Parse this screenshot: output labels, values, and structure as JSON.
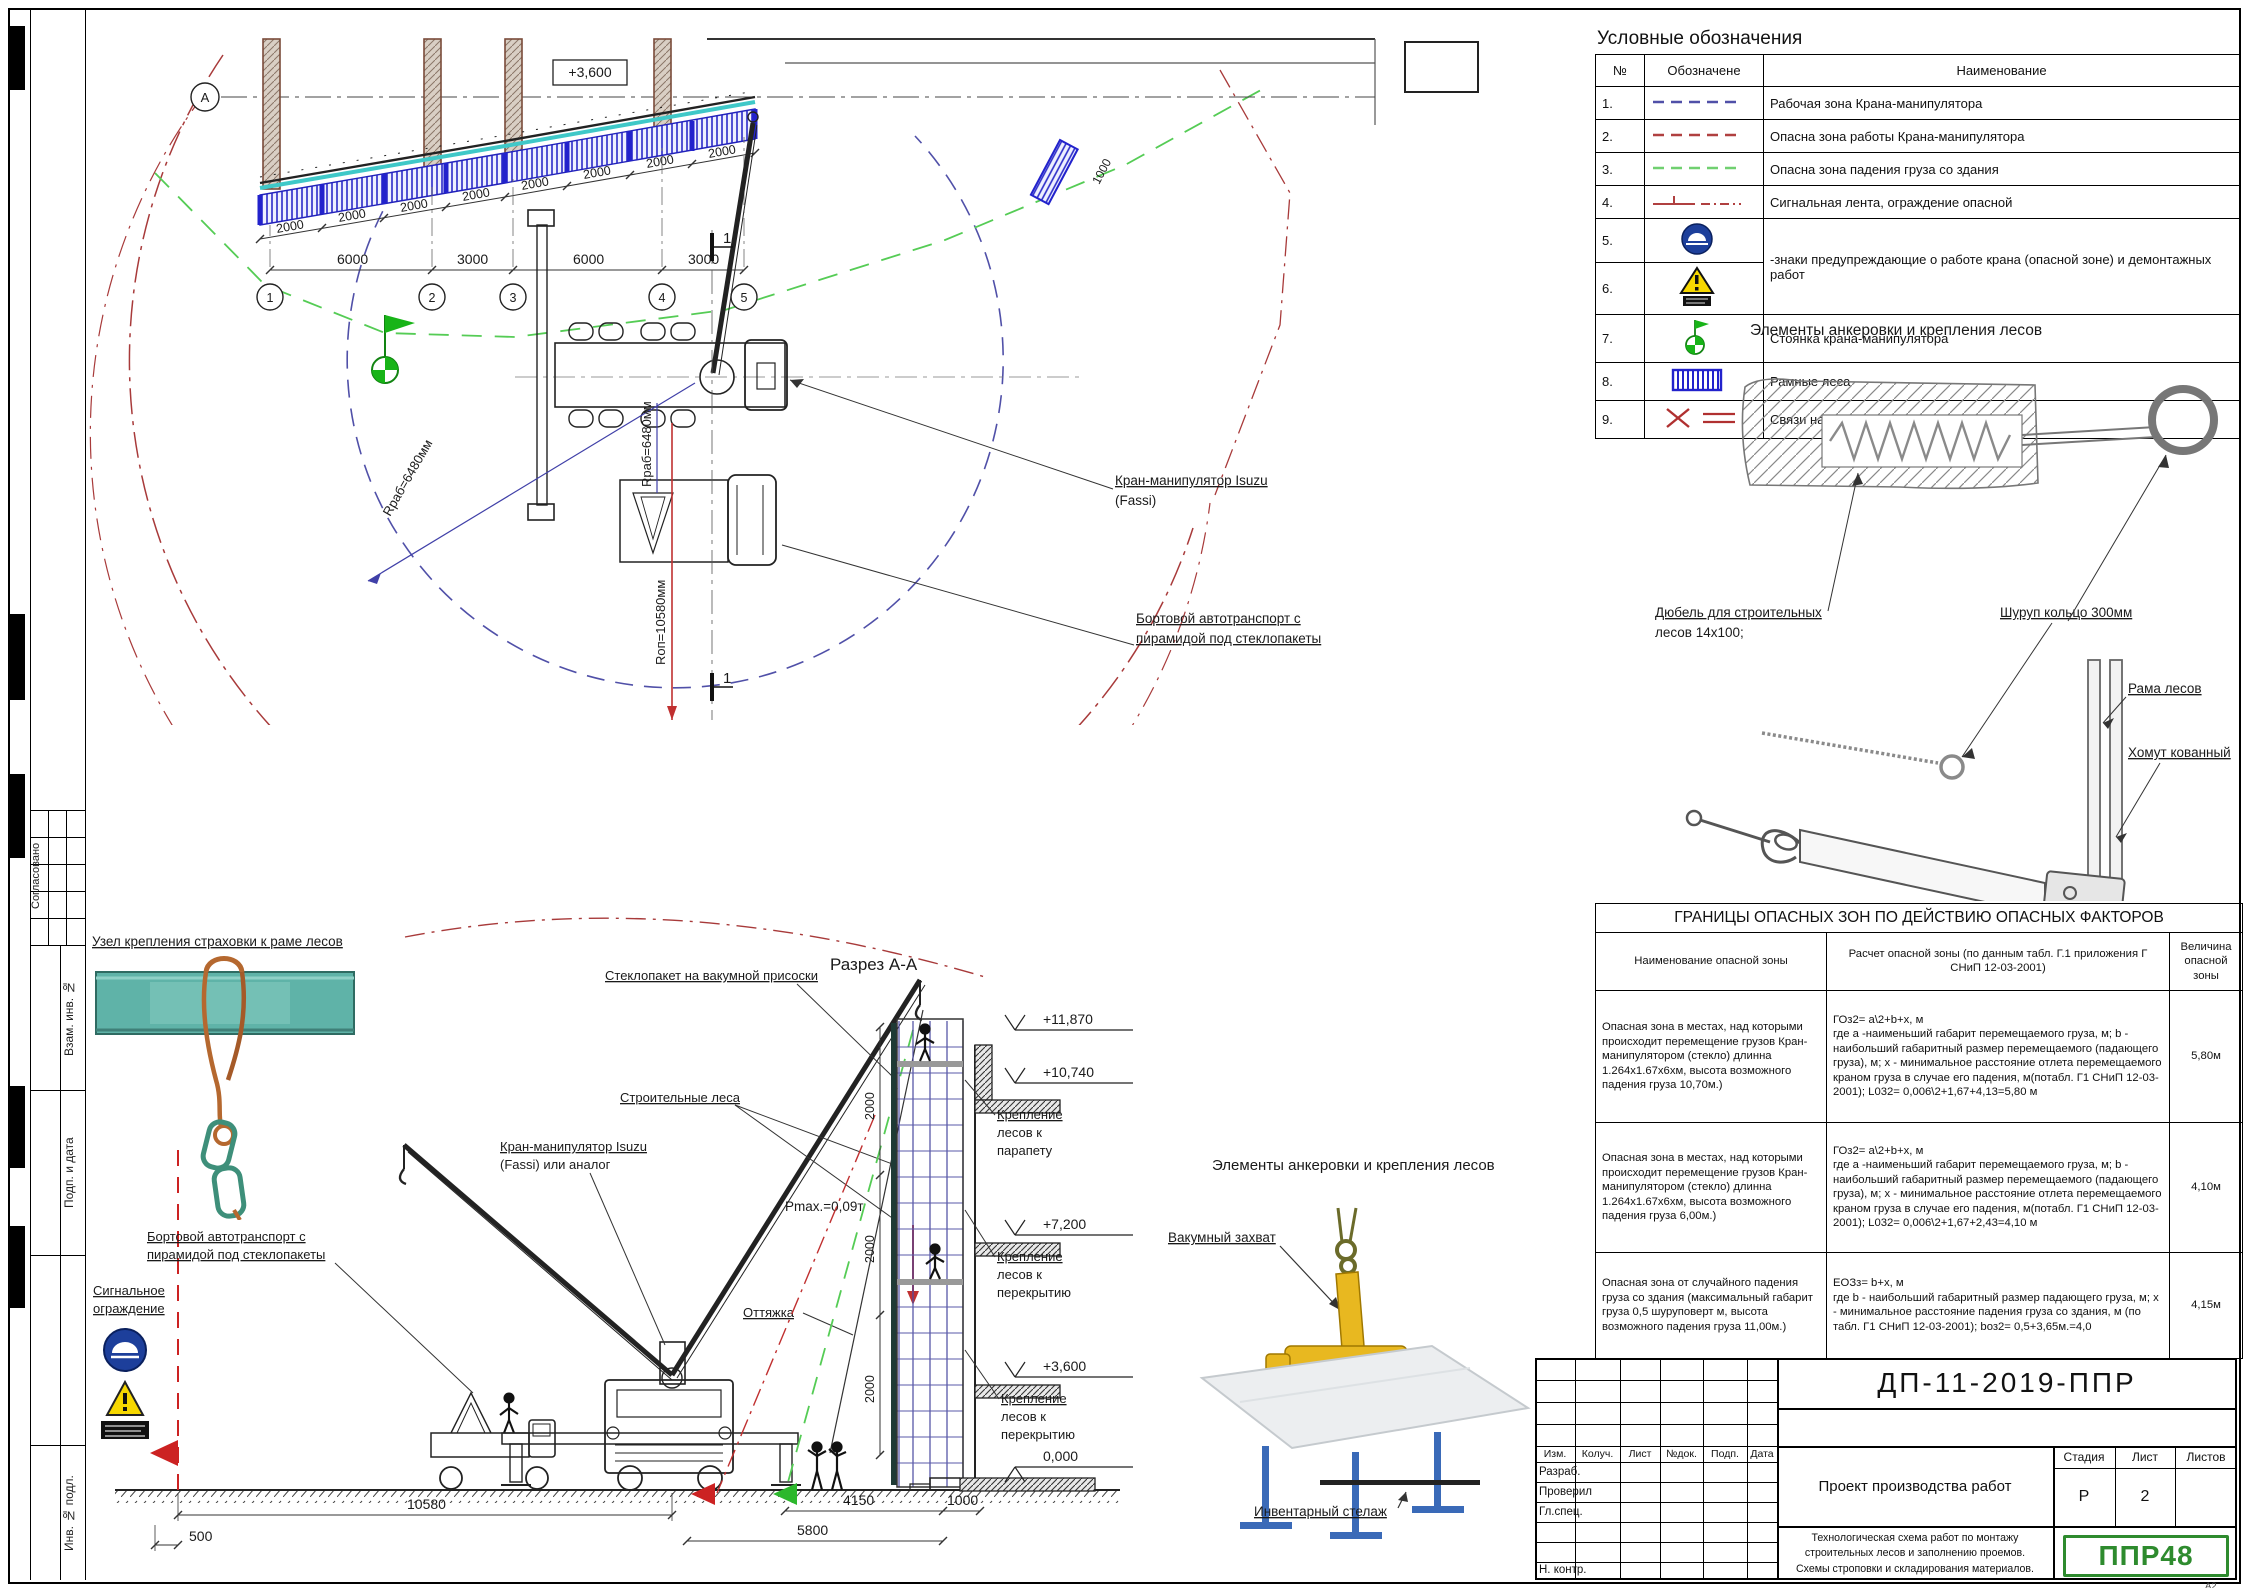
{
  "page": {
    "format": "А2"
  },
  "frame": {
    "approved": "Согласовано",
    "label_vzam": "Взам. инв. №",
    "label_podp": "Подп. и дата",
    "label_inv": "Инв. № подл."
  },
  "legend": {
    "title": "Условные обозначения",
    "col_num": "№",
    "col_sym": "Обозначене",
    "col_name": "Наименование",
    "rows": [
      {
        "num": "1.",
        "name": "Рабочая зона Крана-манипулятора"
      },
      {
        "num": "2.",
        "name": "Опасна зона работы Крана-манипулятора"
      },
      {
        "num": "3.",
        "name": "Опасна зона падения груза со здания"
      },
      {
        "num": "4.",
        "name": "Сигнальная лента, ограждение опасной"
      },
      {
        "num": "5.",
        "name": "-знаки предупреждающие о работе крана (опасной зоне) и демонтажных работ"
      },
      {
        "num": "6.",
        "name": ""
      },
      {
        "num": "7.",
        "name": "Стоянка крана-манипулятора"
      },
      {
        "num": "8.",
        "name": "Рамные леса"
      },
      {
        "num": "9.",
        "name": "Связи на лесах"
      }
    ]
  },
  "anchors": {
    "title": "Элементы анкеровки и крепления лесов",
    "dowel1": "Дюбель для строительных",
    "dowel2": "лесов 14х100;",
    "ring": "Шуруп кольцо 300мм",
    "frame": "Рама лесов",
    "clamp": "Хомут кованный",
    "hook": "Крюк-труба"
  },
  "danger": {
    "title": "ГРАНИЦЫ ОПАСНЫХ ЗОН ПО ДЕЙСТВИЮ ОПАСНЫХ ФАКТОРОВ",
    "h_zone": "Наименование опасной зоны",
    "h_calc": "Расчет опасной зоны (по данным табл. Г.1 приложения Г СНиП 12-03-2001)",
    "h_val": "Величина опасной зоны",
    "rows": [
      {
        "zone": "Опасная зона в местах, над которыми происходит перемещение грузов Кран-манипулятором (стекло)  длинна 1.264х1.67х6хм, высота возможного падения груза 10,70м.)",
        "calc": "ГОз2= а\\2+b+х, м\nгде а -наименьший габарит перемещаемого груза, м; b - наибольший габаритный размер перемещаемого (падающего груза), м; х - минимальное расстояние отлета перемещаемого краном груза в случае его падения, м(потабл. Г1 СНиП 12-03-2001); L032= 0,006\\2+1,67+4,13=5,80 м",
        "val": "5,80м"
      },
      {
        "zone": "Опасная зона в местах, над которыми происходит перемещение грузов Кран-манипулятором (стекло)  длинна 1.264х1.67х6хм, высота возможного падения груза 6,00м.)",
        "calc": "ГОз2= а\\2+b+х, м\nгде а -наименьший габарит перемещаемого груза, м; b - наибольший габаритный размер перемещаемого (падающего груза), м; х - минимальное расстояние отлета перемещаемого краном груза в случае его падения, м(потабл. Г1 СНиП 12-03-2001); L032= 0,006\\2+1,67+2,43=4,10 м",
        "val": "4,10м"
      },
      {
        "zone": "Опасная зона от случайного падения груза со здания (максимальный габарит груза 0,5 шурупoверт м, высота возможного падения груза 11,00м.)",
        "calc": "ЕОЗз= b+х, м\nгде b - наибольший габаритный размер падающего груза, м; х - минимальное расстояние падения груза со здания, м (по табл. Г1 СНиП 12-03-2001); bоз2= 0,5+3,65м.=4,0",
        "val": "4,15м"
      }
    ]
  },
  "titleblock": {
    "doc": "ДП-11-2019-ППР",
    "c1": "Изм.",
    "c2": "Колуч.",
    "c3": "Лист",
    "c4": "№док.",
    "c5": "Подп.",
    "c6": "Дата",
    "r1": "Разраб.",
    "r2": "Проверил",
    "r3": "Гл.спец.",
    "r4": "Н. контр.",
    "project": "Проект производства работ",
    "stage_l": "Стадия",
    "sheet_l": "Лист",
    "sheets_l": "Листов",
    "stage": "Р",
    "sheet": "2",
    "desc1": "Технологическая схема работ по монтажу",
    "desc2": "строительных лесов и заполнению проемов.",
    "desc3": "Схемы строповки и складирования материалов.",
    "logo": "ППР48",
    "fmt": "А2"
  },
  "plan": {
    "elev": "+3,600",
    "gridA": "А",
    "g1": "1",
    "g2": "2",
    "g3": "3",
    "g4": "4",
    "g5": "5",
    "d2000": "2000",
    "d6000": "6000",
    "d3000": "3000",
    "d1000": "1000",
    "crane1": "Кран-манипулятор Isuzu",
    "crane2": "(Fassi)",
    "truck1": "Бортовой автотранспорт с",
    "truck2": "пирамидой под стеклопакеты",
    "r_rab": "Rраб=6480мм",
    "r_op": "Rоп=10580мм",
    "mark": "1"
  },
  "section": {
    "title": "Разрез А-А",
    "glass": "Стеклопакет на вакумной присоски",
    "scaffold": "Строительные леса",
    "crane1": "Кран-манипулятор Isuzu",
    "crane2": "(Fassi) или аналог",
    "guy": "Оттяжка",
    "pmax": "Pmax.=0,09т",
    "truck1": "Бортовой автотранспорт с",
    "truck2": "пирамидой под стеклопакеты",
    "fence1": "Сигнальное",
    "fence2": "ограждение",
    "att1a": "Крепление",
    "att1b": "лесов к",
    "att1c": "парапету",
    "att2a": "Крепление",
    "att2b": "лесов к",
    "att2c": "перекрытию",
    "lv1": "+11,870",
    "lv2": "+10,740",
    "lv3": "+7,200",
    "lv4": "+3,600",
    "lv5": "0,000",
    "d500": "500",
    "d10580": "10580",
    "d4150": "4150",
    "d1000": "1000",
    "d5800": "5800",
    "d2000": "2000"
  },
  "safety": {
    "title": "Узел крепления страховки к раме лесов"
  },
  "vacuum": {
    "title": "Элементы анкеровки и крепления лесов",
    "grab": "Вакумный захват",
    "rack": "Инвентарный стелаж"
  }
}
